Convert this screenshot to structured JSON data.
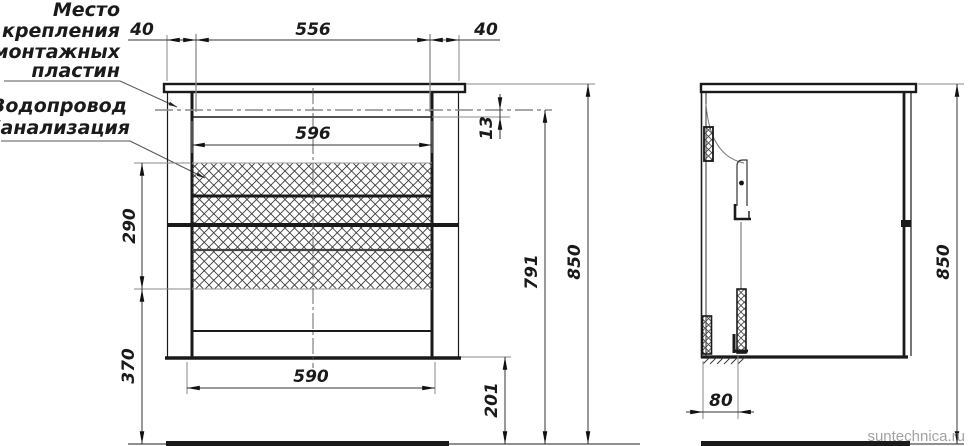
{
  "labels": {
    "mounting_note": [
      "Место",
      "крепления",
      "монтажных",
      "пластин"
    ],
    "plumbing_note": [
      "Водопровод",
      "Канализация"
    ]
  },
  "dimensions": {
    "front": {
      "left_plate_offset": "40",
      "plate_spacing": "556",
      "right_plate_offset": "40",
      "inner_width": "596",
      "plate_drop": "13",
      "service_zone_height": "290",
      "zone_to_floor": "370",
      "bottom_width": "590",
      "floor_to_bottom": "201",
      "floor_to_plate": "791",
      "total_height": "850"
    },
    "side": {
      "plate_depth_offset": "80",
      "total_height": "850"
    }
  },
  "watermark": "suntechnica.ru",
  "colors": {
    "line": "#1a1a1a",
    "dimension": "#333333",
    "extension": "#8a8a8a",
    "hatch": "#3c3c3c",
    "watermark": "#a3a3a3"
  }
}
